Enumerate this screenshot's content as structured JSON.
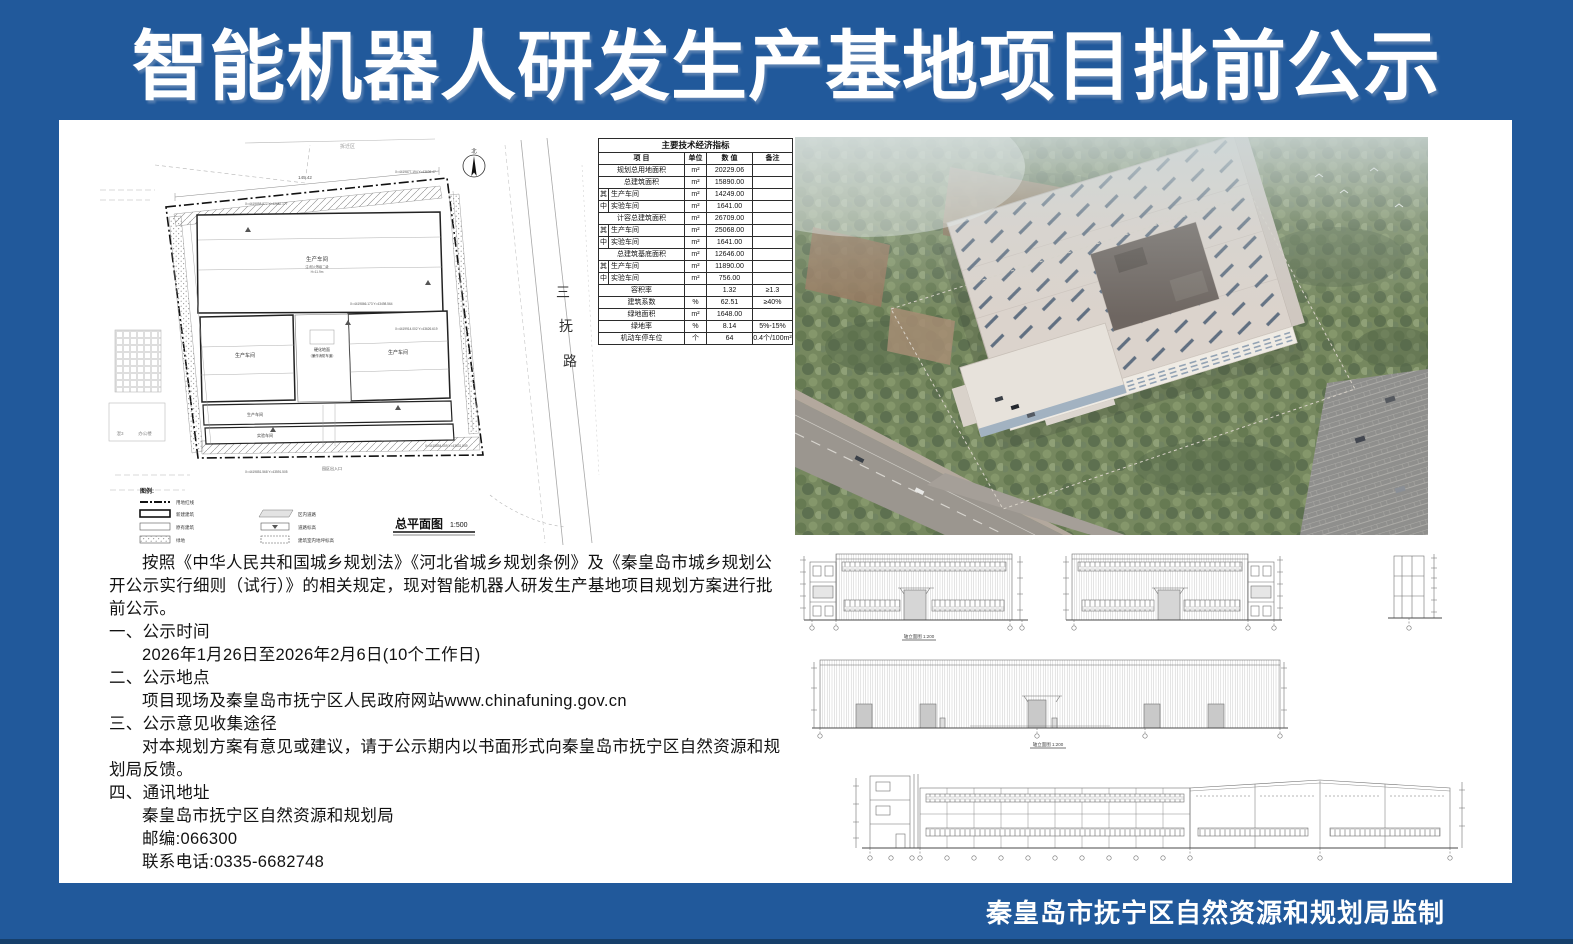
{
  "title": "智能机器人研发生产基地项目批前公示",
  "credit": "秦皇岛市抚宁区自然资源和规划局监制",
  "colors": {
    "frame": "#21599B",
    "frame_dark": "#163F6B",
    "paper": "#FFFFFF",
    "ink": "#121212",
    "drawing_line": "#6B6B6B"
  },
  "indicators": {
    "title": "主要技术经济指标",
    "headers": [
      "项  目",
      "单位",
      "数  值",
      "备注"
    ],
    "rows": [
      {
        "prefix": "",
        "label": "规划总用地面积",
        "unit": "m²",
        "value": "20229.06",
        "note": ""
      },
      {
        "prefix": "",
        "label": "总建筑面积",
        "unit": "m²",
        "value": "15890.00",
        "note": ""
      },
      {
        "prefix": "其",
        "label": "生产车间",
        "unit": "m²",
        "value": "14249.00",
        "note": ""
      },
      {
        "prefix": "中",
        "label": "实验车间",
        "unit": "m²",
        "value": "1641.00",
        "note": ""
      },
      {
        "prefix": "",
        "label": "计容总建筑面积",
        "unit": "m²",
        "value": "26709.00",
        "note": ""
      },
      {
        "prefix": "其",
        "label": "生产车间",
        "unit": "m²",
        "value": "25068.00",
        "note": ""
      },
      {
        "prefix": "中",
        "label": "实验车间",
        "unit": "m²",
        "value": "1641.00",
        "note": ""
      },
      {
        "prefix": "",
        "label": "总建筑基底面积",
        "unit": "m²",
        "value": "12646.00",
        "note": ""
      },
      {
        "prefix": "其",
        "label": "生产车间",
        "unit": "m²",
        "value": "11890.00",
        "note": ""
      },
      {
        "prefix": "中",
        "label": "实验车间",
        "unit": "m²",
        "value": "756.00",
        "note": ""
      },
      {
        "prefix": "",
        "label": "容积率",
        "unit": "",
        "value": "1.32",
        "note": "≥1.3"
      },
      {
        "prefix": "",
        "label": "建筑系数",
        "unit": "%",
        "value": "62.51",
        "note": "≥40%"
      },
      {
        "prefix": "",
        "label": "绿地面积",
        "unit": "m²",
        "value": "1648.00",
        "note": ""
      },
      {
        "prefix": "",
        "label": "绿地率",
        "unit": "%",
        "value": "8.14",
        "note": "5%-15%"
      },
      {
        "prefix": "",
        "label": "机动车停车位",
        "unit": "个",
        "value": "64",
        "note": "0.4个/100m²"
      }
    ]
  },
  "site_plan": {
    "caption": "总平面图",
    "scale": "1:500",
    "road_chars": [
      "三",
      "抚",
      "路"
    ],
    "north_label": "北",
    "area_label": "拆迁区",
    "legend_title": "图例:",
    "legend_left": [
      "用地红线",
      "新建建筑",
      "原有建筑",
      "绿地"
    ],
    "legend_right": [
      "区内道路",
      "道路标高",
      "建筑室内地坪标高"
    ],
    "hall_label": "生产车间",
    "hall_note": "注:耐火等级二级",
    "hall_height": "H=11.9m",
    "yard_label": "硬化地面",
    "yard_label2": "（兼作消防车道）",
    "strip_label1": "生产车间",
    "strip_label2": "实验车间",
    "neighbor_label": "办公楼",
    "neighbor_type": "混3",
    "entrance_label": "园区出入口",
    "dim_label": "145.42",
    "coord_labels": [
      "X=4419877.194 Y=43636.47",
      "X=4419866.173 Y=43498.564",
      "X=4419914.002 Y=43626.619",
      "X=4419858.877 Y=42682.177",
      "X=4419854.059 Y=43631.049",
      "X=4419851.568 Y=43591.505"
    ]
  },
  "elevations": {
    "captions": [
      "轴立面图 1:200",
      "轴立面图 1:200"
    ]
  },
  "notice": {
    "lines": [
      {
        "t": "按照《中华人民共和国城乡规划法》《河北省城乡规划条例》及《秦皇岛市城乡规划公",
        "i": 1
      },
      {
        "t": "开公示实行细则（试行）》的相关规定，现对智能机器人研发生产基地项目规划方案进行批",
        "i": 0
      },
      {
        "t": "前公示。",
        "i": 0
      },
      {
        "t": "一、公示时间",
        "i": 0
      },
      {
        "t": "2026年1月26日至2026年2月6日(10个工作日)",
        "i": 1
      },
      {
        "t": "二、公示地点",
        "i": 0
      },
      {
        "t": "项目现场及秦皇岛市抚宁区人民政府网站www.chinafuning.gov.cn",
        "i": 1
      },
      {
        "t": "三、公示意见收集途径",
        "i": 0
      },
      {
        "t": "对本规划方案有意见或建议，请于公示期内以书面形式向秦皇岛市抚宁区自然资源和规",
        "i": 1
      },
      {
        "t": "划局反馈。",
        "i": 0
      },
      {
        "t": "四、通讯地址",
        "i": 0
      },
      {
        "t": "秦皇岛市抚宁区自然资源和规划局",
        "i": 1
      },
      {
        "t": "邮编:066300",
        "i": 1
      },
      {
        "t": "联系电话:0335-6682748",
        "i": 1
      }
    ]
  }
}
